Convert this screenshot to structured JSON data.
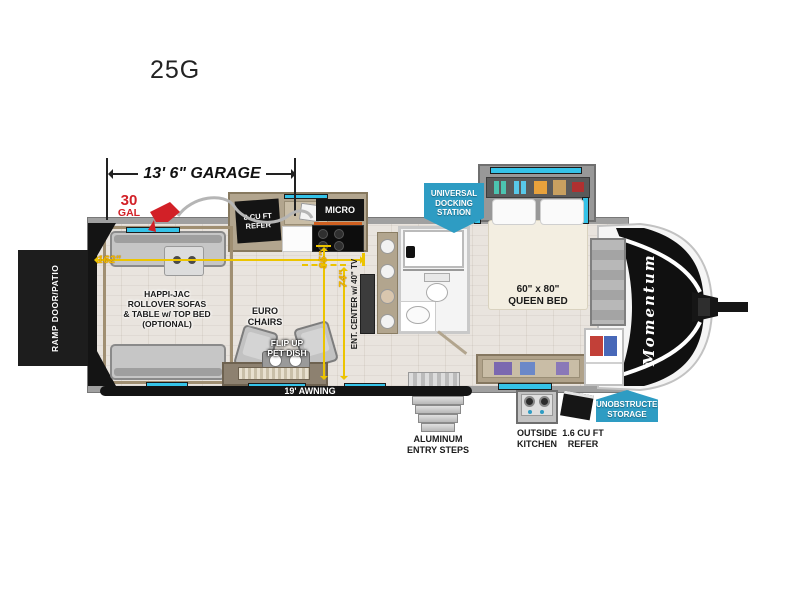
{
  "title": "25G",
  "colors": {
    "dimension_yellow": "#f0b400",
    "accent_red": "#d22027",
    "badge_blue": "#2e9cc3",
    "window_cyan": "#35c3e8",
    "ramp_black": "#141414"
  },
  "dimensions": {
    "garage_length": "13' 6\" GARAGE",
    "interior_length": "162\"",
    "depth_95": "95\"",
    "depth_74": "74\"",
    "awning": "19' AWNING"
  },
  "fuel_station": {
    "amount": "30",
    "unit": "GAL"
  },
  "exterior": {
    "ramp_door": "RAMP DOOR/PATIO",
    "docking_station": [
      "UNIVERSAL",
      "DOCKING",
      "STATION"
    ],
    "storage": [
      "UNOBSTRUCTED",
      "STORAGE"
    ],
    "entry_steps": [
      "ALUMINUM",
      "ENTRY STEPS"
    ],
    "outside_kitchen": [
      "OUTSIDE",
      "KITCHEN"
    ],
    "outside_refer": [
      "1.6 CU FT",
      "REFER"
    ],
    "brand_logo": "Momentum"
  },
  "interior": {
    "refer": [
      "8 CU FT",
      "REFER"
    ],
    "micro": "MICRO",
    "garage_sofas": [
      "HAPPI-JAC",
      "ROLLOVER SOFAS",
      "& TABLE w/ TOP BED",
      "(OPTIONAL)"
    ],
    "euro_chairs": [
      "EURO",
      "CHAIRS"
    ],
    "pet_dish": [
      "FLIP UP",
      "PET DISH"
    ],
    "ent_center": "ENT. CENTER w/ 40\" TV",
    "queen_bed": [
      "60\" x 80\"",
      "QUEEN BED"
    ]
  }
}
